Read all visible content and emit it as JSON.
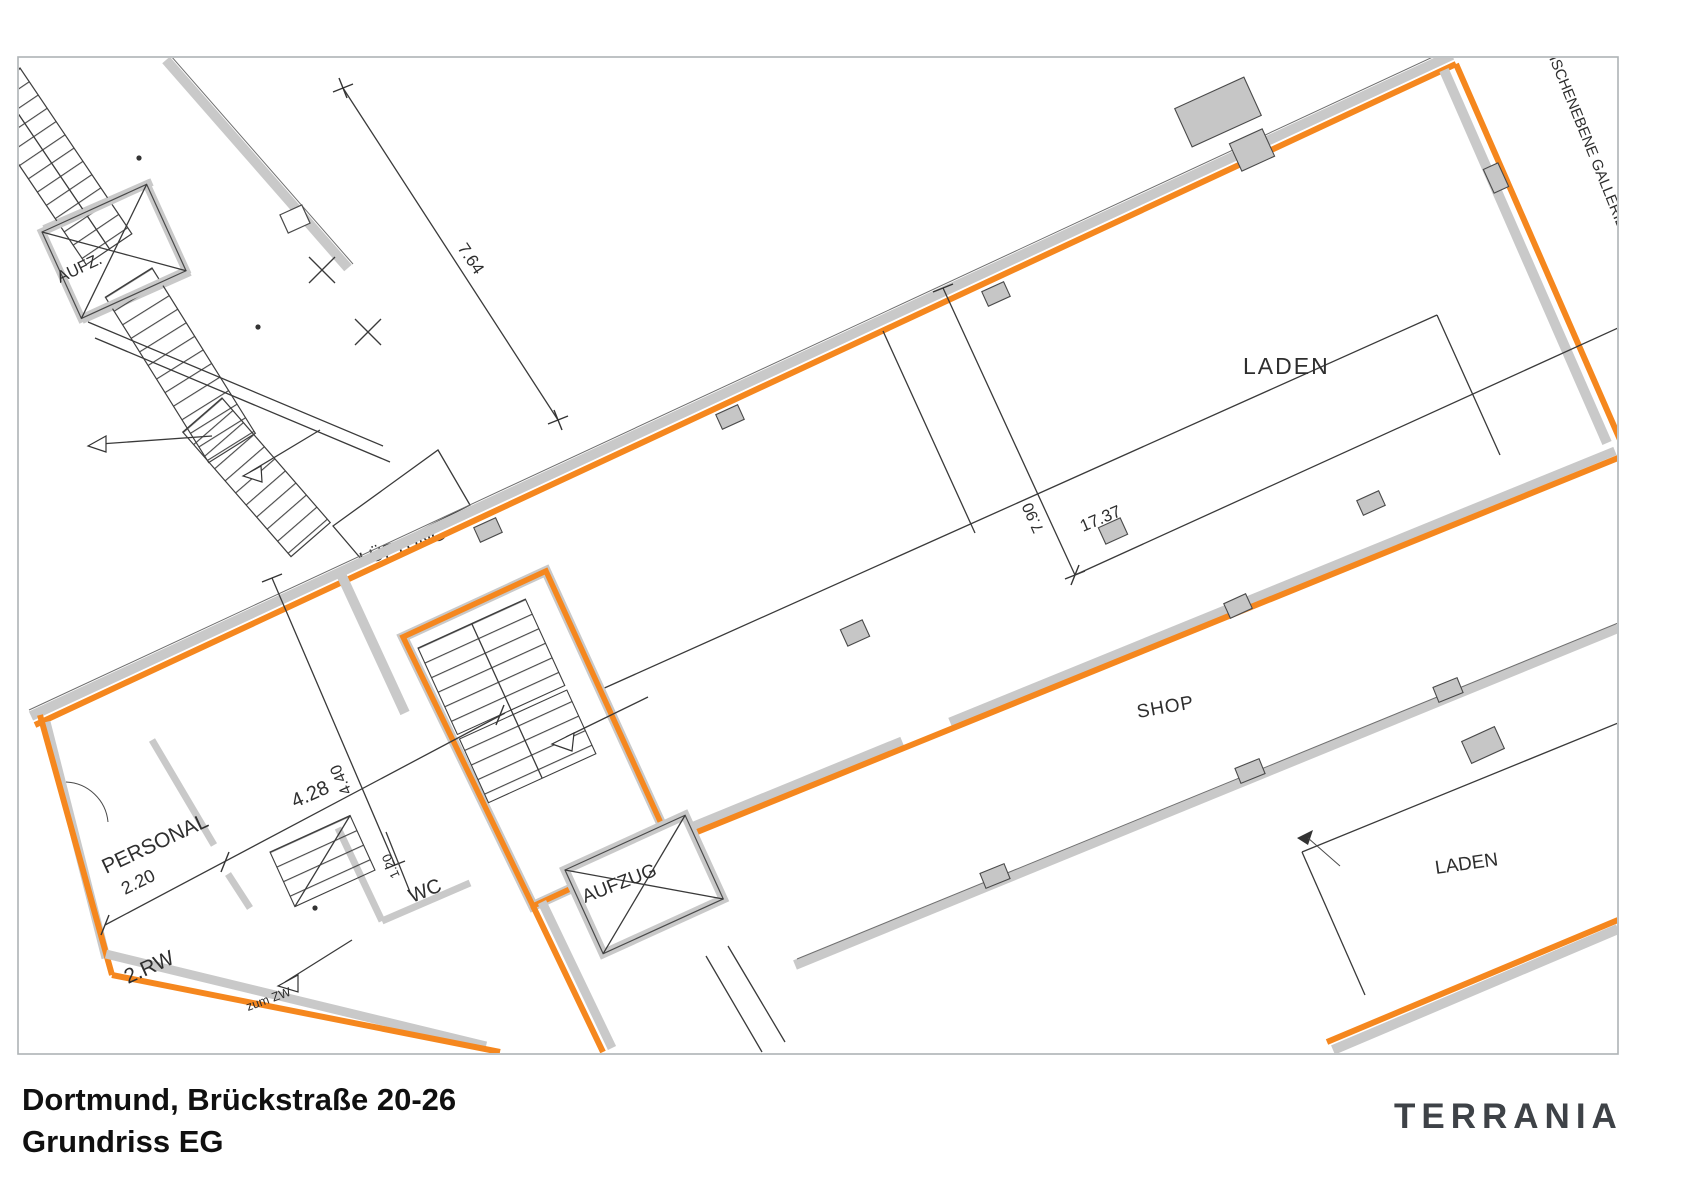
{
  "plan": {
    "labels": {
      "aufz": "AUFZ.",
      "lueftung": "LÜFTUNG",
      "laden_top": "LADEN",
      "gallery": "ISCHENEBENE GALLERIE.",
      "shop": "SHOP",
      "laden_bottom": "LADEN",
      "personal": "PERSONAL",
      "rw2": "2.RW",
      "wc": "WC",
      "aufzug": "AUFZUG",
      "zum_zw": "zum ZW"
    },
    "dimensions": {
      "d764": "7.64",
      "d790": "7.90",
      "d1737": "17.37",
      "d428": "4.28",
      "d440": "4.40",
      "d220": "2.20",
      "d120": "1.20"
    }
  },
  "footer": {
    "title_line1": "Dortmund, Brückstraße 20-26",
    "title_line2": "Grundriss EG",
    "brand": "TERRANIA"
  },
  "colors": {
    "outline_orange": "#F5871E",
    "wall_gray": "#C9C9C9",
    "line_dark": "#3A3A3A",
    "brand_text": "#3E4247"
  }
}
